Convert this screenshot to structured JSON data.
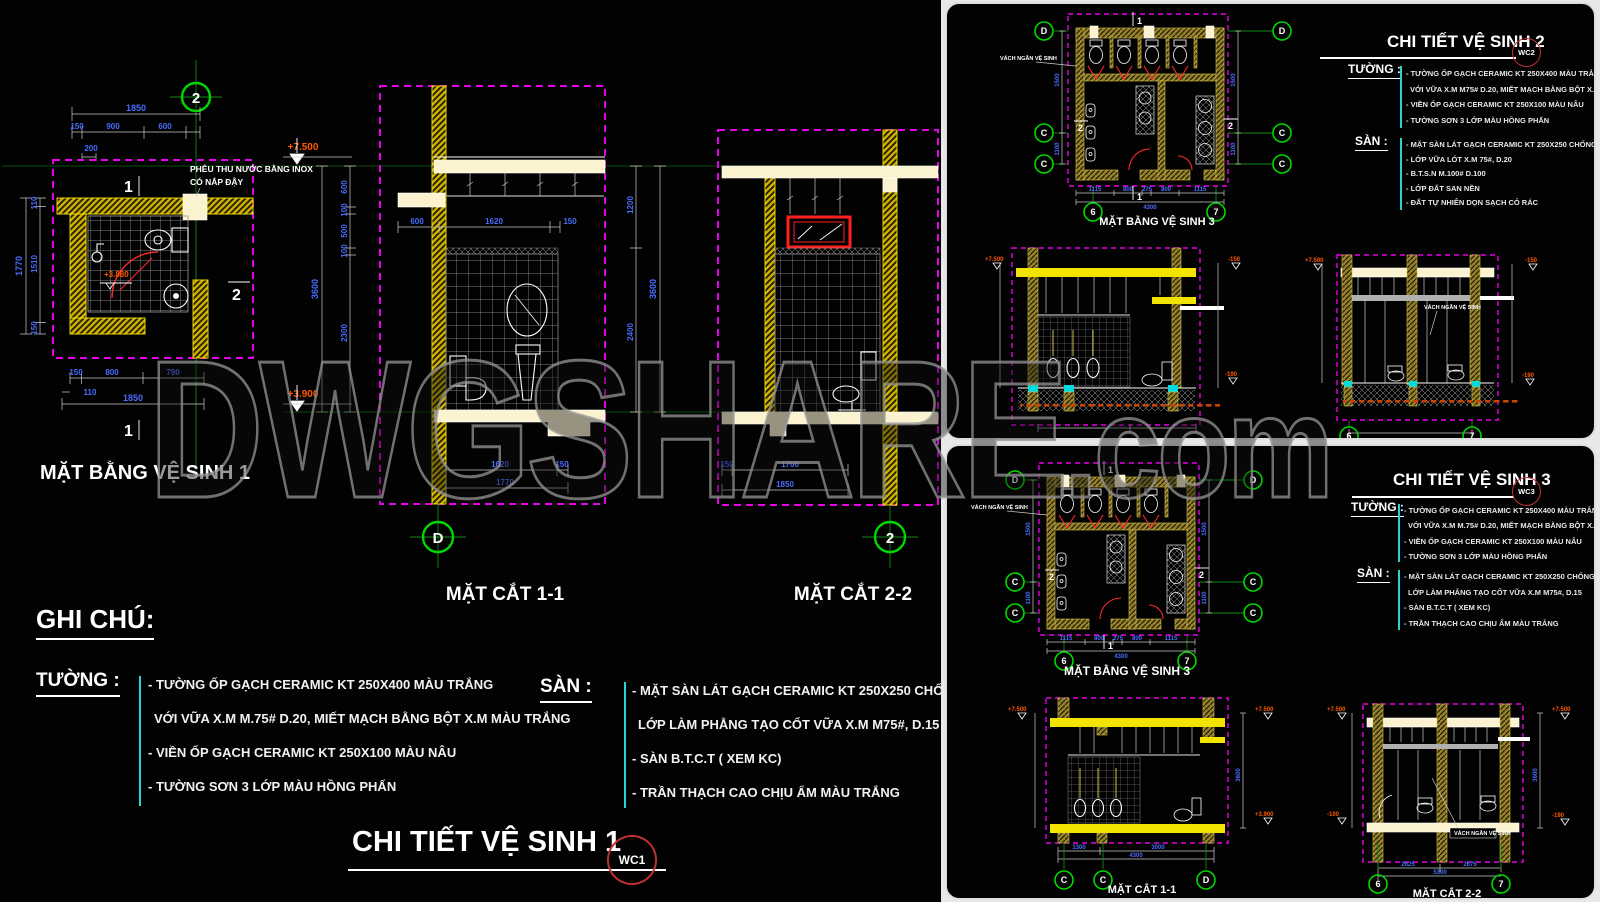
{
  "watermark": {
    "main": "DWGSHARE",
    "suffix": ".com"
  },
  "sheet1": {
    "plan": {
      "label": "MẶT BẰNG VỆ SINH 1",
      "grid_top": "2",
      "note_line1": "PHỄU THU NƯỚC BẰNG INOX",
      "note_line2": "CÓ NẮP ĐẬY",
      "level_top": "+7.500",
      "level_floor": "+3.880",
      "dim_total_top": "1850",
      "dims_top": [
        "150",
        "900",
        "600"
      ],
      "dim_200": "200",
      "dim_left_total": "1770",
      "dims_left": [
        "110",
        "1510",
        "150"
      ],
      "dims_bottom": [
        "150",
        "800",
        "790"
      ],
      "dim_110": "110",
      "dim_total_bottom": "1850",
      "mark_1": "1",
      "mark_2": "2"
    },
    "sec11": {
      "label": "MẶT CẮT 1-1",
      "grid": "D",
      "level": "+3.900",
      "dims_left": [
        "600",
        "100",
        "500",
        "100",
        "2300"
      ],
      "dim_left_total": "3600",
      "dims_mid": [
        "600",
        "1620",
        "150"
      ],
      "dims_bottom": [
        "1620",
        "150"
      ],
      "dim_bottom_total": "1770"
    },
    "sec22": {
      "label": "MẶT CẮT 2-2",
      "grid": "2",
      "dims_left": [
        "1200",
        "2400"
      ],
      "dim_left_total": "3600",
      "dims_bottom": [
        "150",
        "1700"
      ],
      "dim_bottom_total": "1850"
    },
    "notes": {
      "heading": "GHI CHÚ:",
      "wall_label": "TƯỜNG :",
      "wall": [
        "- TƯỜNG ỐP GẠCH CERAMIC KT 250X400 MÀU TRẮNG",
        "VỚI VỮA X.M M.75# D.20, MIẾT MẠCH BẰNG BỘT X.M MÀU TRẮNG",
        "- VIỀN ỐP GẠCH CERAMIC KT 250X100 MÀU NÂU",
        "- TƯỜNG SƠN 3 LỚP MÀU HỒNG PHẤN"
      ],
      "floor_label": "SÀN :",
      "floor": [
        "- MẶT SÀN LÁT GẠCH CERAMIC KT 250X250 CHỐNG TRƠN MÀU",
        "LỚP LÀM PHẲNG TẠO CỐT VỮA X.M M75#, D.15",
        "- SÀN B.T.C.T ( XEM KC)",
        "- TRẦN THẠCH CAO CHỊU ẨM MÀU TRẮNG"
      ]
    },
    "title": "CHI TIẾT VỆ SINH 1",
    "badge": "WC1"
  },
  "sheet2": {
    "title": "CHI TIẾT VỆ SINH 2",
    "badge": "WC2",
    "plan": {
      "label": "MẶT BẰNG VỆ SINH 3",
      "partition_note": "VÁCH NGĂN VỆ SINH",
      "grid_d": "D",
      "grid_c": "C",
      "grid_6": "6",
      "grid_7": "7",
      "mark_1": "1",
      "mark_2": "2",
      "dims_bottom": [
        "1115",
        "800",
        "275",
        "800",
        "1115"
      ],
      "dim_bottom_total": "4300",
      "dims_side": [
        "1500",
        "1100"
      ]
    },
    "elevA": {
      "level_left": "+7.500",
      "level_right_top": "-150",
      "level_right_bottom": "-190"
    },
    "elevB": {
      "level_left": "+7.500",
      "level_right_top": "-150",
      "level_right_bottom": "-190",
      "partition_note": "VÁCH NGĂN VỆ SINH",
      "grid_6": "6",
      "grid_7": "7"
    },
    "notes": {
      "wall_label": "TƯỜNG :",
      "wall": [
        "- TƯỜNG ỐP GẠCH CERAMIC KT 250X400 MÀU TRẮNG",
        "VỚI VỮA X.M M75# D.20, MIẾT MẠCH BẰNG BỘT X.M MÀU TRẮNG",
        "- VIỀN ỐP GẠCH CERAMIC KT 250X100 MÀU NÂU",
        "- TƯỜNG SƠN 3 LỚP MÀU HỒNG PHẤN"
      ],
      "floor_label": "SÀN :",
      "floor": [
        "- MẶT SÀN LÁT GẠCH CERAMIC KT 250X250 CHỐNG TRƠN MÀU NÂU",
        "- LỚP VỮA LÓT X.M 75#, D.20",
        "- B.T.S.N M.100# D.100",
        "- LỚP ĐẤT SAN NỀN",
        "- ĐẤT TỰ NHIÊN DỌN SẠCH CỎ RÁC"
      ]
    }
  },
  "sheet3": {
    "title": "CHI TIẾT VỆ SINH 3",
    "badge": "WC3",
    "plan_label": "MẶT BẰNG VỆ SINH 3",
    "sec11": {
      "label": "MẶT CẮT 1-1",
      "grid_c1": "C",
      "grid_c2": "C",
      "grid_d": "D",
      "level_left": "+7.500",
      "level_right_top": "+7.500",
      "level_right_bottom": "+3.900",
      "dim_side": "3600",
      "dims_bottom": [
        "1300",
        "3000"
      ],
      "dim_bottom_total": "4300"
    },
    "sec22": {
      "label": "MẶT CẮT 2-2",
      "grid_6": "6",
      "grid_7": "7",
      "level_left_top": "+7.500",
      "level_left_bottom": "-100",
      "level_right_top": "+7.500",
      "level_right_bottom": "-190",
      "partition_note": "VÁCH NGĂN VỆ SINH",
      "dim_side": "3600",
      "dims_bottom": [
        "2625",
        "2675"
      ],
      "dim_bottom_total": "5300"
    },
    "notes": {
      "wall_label": "TƯỜNG :",
      "wall": [
        "- TƯỜNG ỐP GẠCH CERAMIC KT 250X400 MÀU TRẮNG",
        "VỚI VỮA X.M M.75# D.20, MIẾT MẠCH BẰNG BỘT X.M MÀU TRẮNG",
        "- VIỀN ỐP GẠCH CERAMIC KT 250X100 MÀU NÂU",
        "- TƯỜNG SƠN 3 LỚP MÀU HỒNG PHẤN"
      ],
      "floor_label": "SÀN :",
      "floor": [
        "- MẶT SÀN LÁT GẠCH CERAMIC KT 250X250 CHỐNG TRƠN MÀU NÂU",
        "LỚP LÀM PHẲNG TẠO CỐT VỮA X.M M75#, D.15",
        "- SÀN B.T.C.T ( XEM KC)",
        "- TRẦN THẠCH CAO CHỊU ẨM MÀU TRẮNG"
      ]
    }
  }
}
